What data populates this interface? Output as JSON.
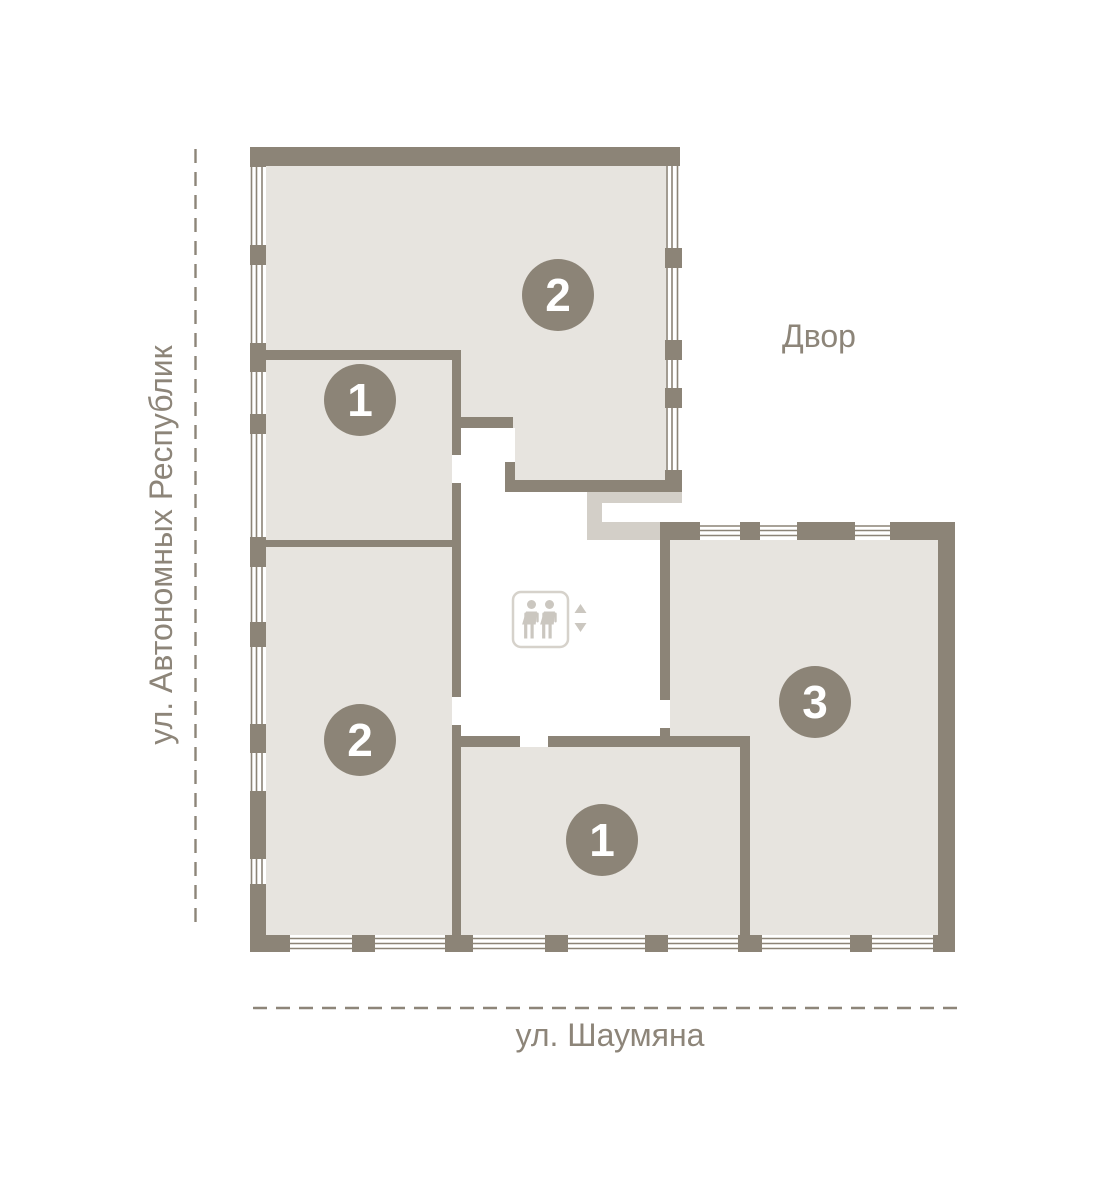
{
  "plan": {
    "streets": {
      "left": "ул. Автономных Республик",
      "bottom": "ул. Шаумяна"
    },
    "courtyard_label": "Двор",
    "apartments": [
      {
        "id": "apt-top",
        "rooms_label": "2"
      },
      {
        "id": "apt-upper-left",
        "rooms_label": "1"
      },
      {
        "id": "apt-lower-left",
        "rooms_label": "2"
      },
      {
        "id": "apt-bottom-middle",
        "rooms_label": "1"
      },
      {
        "id": "apt-right",
        "rooms_label": "3"
      }
    ],
    "elevator": {
      "icon": "elevator-two-persons-icon",
      "up_icon": "triangle-up",
      "down_icon": "triangle-down"
    },
    "colors": {
      "wall": "#8C8477",
      "room": "#E7E4DF",
      "connector": "#D3CFC8",
      "accent-text": "#8D8579",
      "icon-gray": "#CBC7C0",
      "badge": "#8C8477",
      "badge-text": "#FFFFFF"
    }
  }
}
